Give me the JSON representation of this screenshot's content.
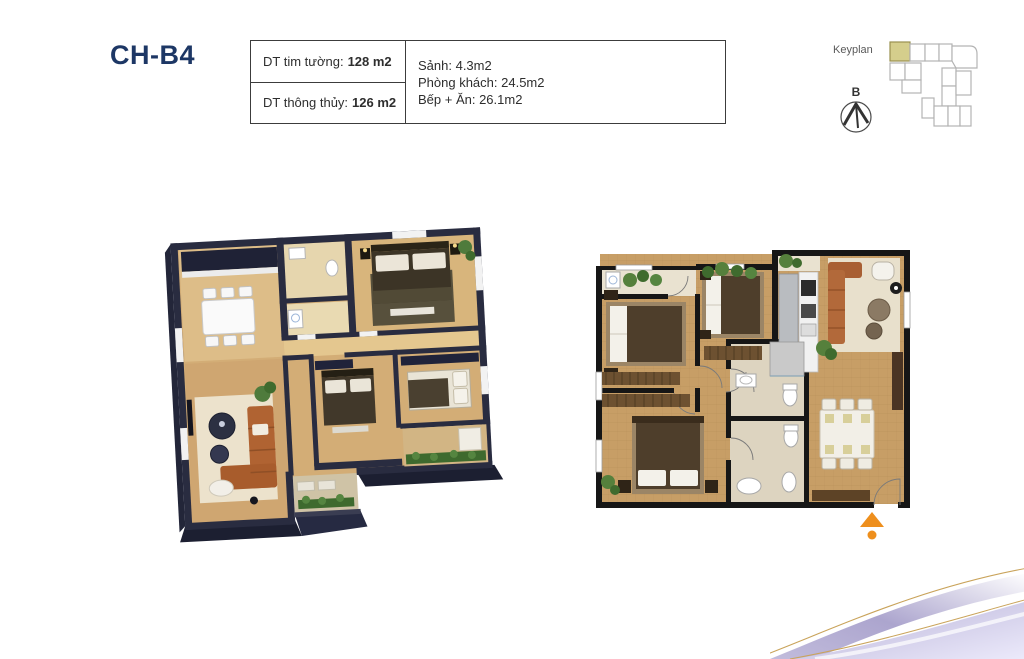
{
  "page": {
    "title": "CH-B4"
  },
  "area_table": {
    "rows": [
      {
        "label": "DT tim tường:",
        "value": "128 m2"
      },
      {
        "label": "DT thông thủy:",
        "value": "126 m2"
      }
    ],
    "details": [
      "Sảnh: 4.3m2",
      "Phòng khách: 24.5m2",
      "Bếp + Ăn: 26.1m2"
    ]
  },
  "keyplan": {
    "label": "Keyplan",
    "compass_label": "B"
  },
  "colors": {
    "title_navy": "#1d3765",
    "keyplan_highlight": "#d5ce8c",
    "keyplan_outline": "#b3b3b3",
    "entry_arrow": "#ee8f1d",
    "wave_lavender": "#b0a9d2",
    "wave_gold": "#c9a35a"
  }
}
